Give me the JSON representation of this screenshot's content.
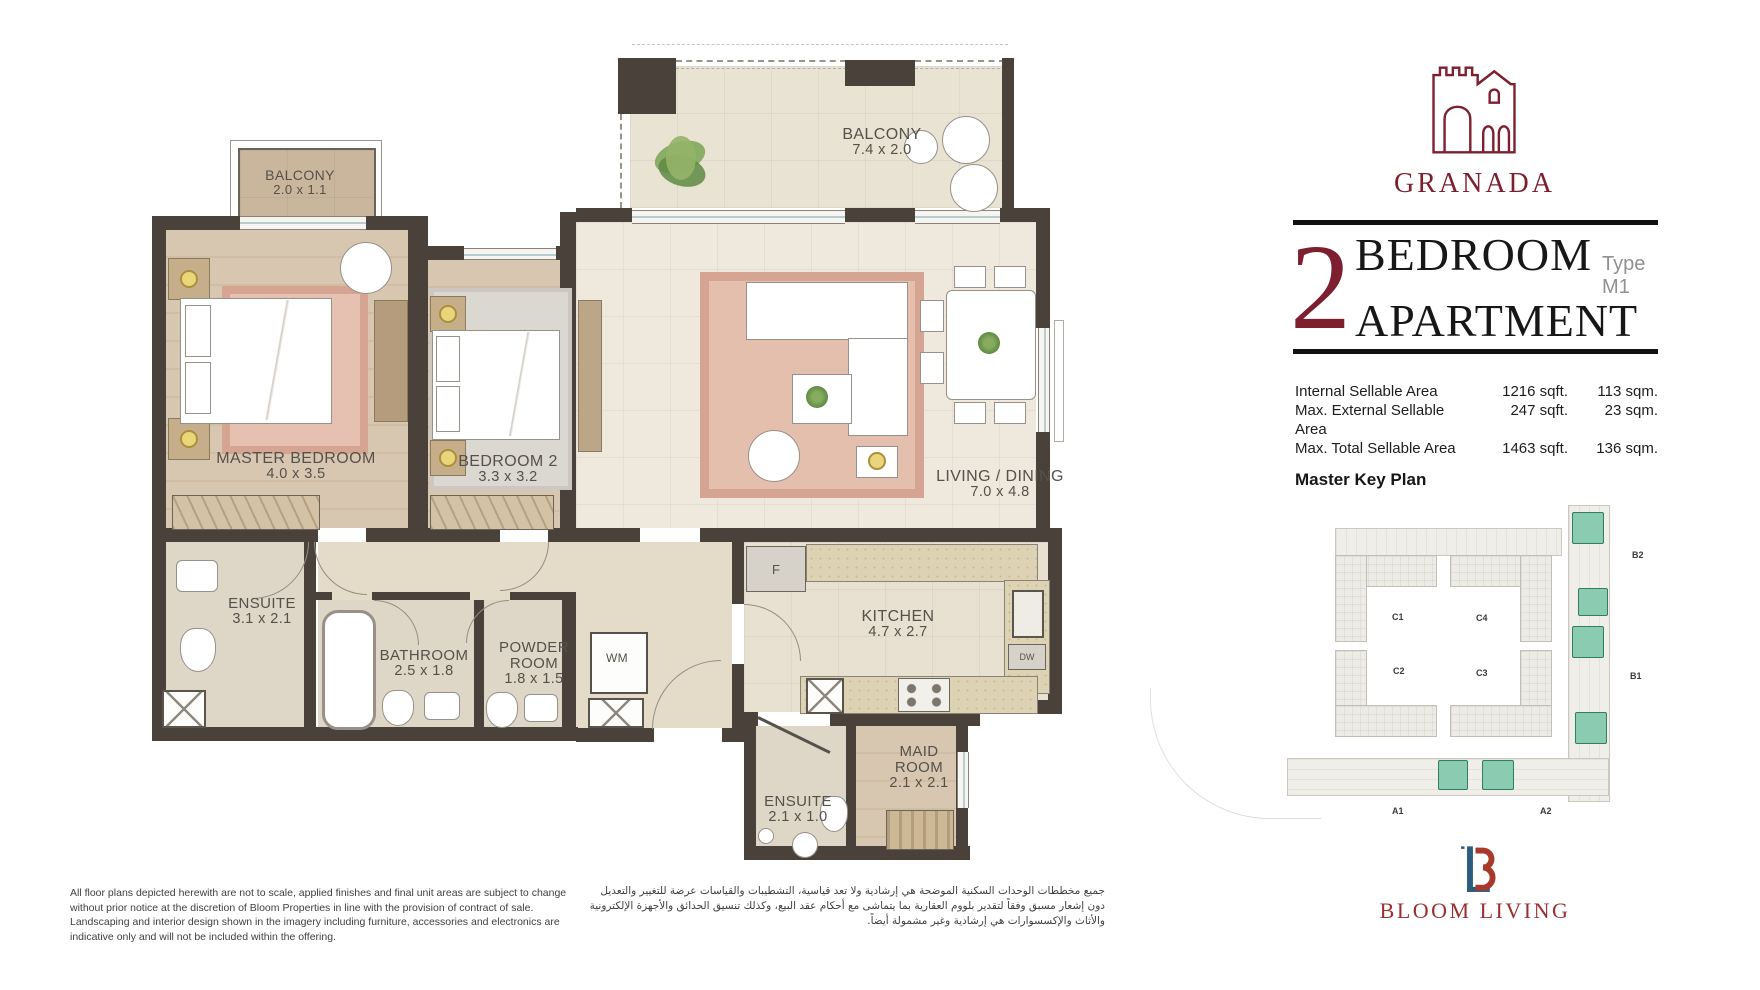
{
  "plan": {
    "rooms": [
      {
        "name": "BALCONY",
        "dims": "2.0 x 1.1"
      },
      {
        "name": "MASTER BEDROOM",
        "dims": "4.0 x 3.5"
      },
      {
        "name": "BEDROOM 2",
        "dims": "3.3 x 3.2"
      },
      {
        "name": "BALCONY",
        "dims": "7.4 x 2.0"
      },
      {
        "name": "LIVING / DINING",
        "dims": "7.0 x 4.8"
      },
      {
        "name": "ENSUITE",
        "dims": "3.1 x 2.1"
      },
      {
        "name": "BATHROOM",
        "dims": "2.5 x 1.8"
      },
      {
        "name": "POWDER ROOM",
        "dims": "1.8 x 1.5"
      },
      {
        "name": "KITCHEN",
        "dims": "4.7 x 2.7"
      },
      {
        "name": "MAID ROOM",
        "dims": "2.1 x 2.1"
      },
      {
        "name": "ENSUITE",
        "dims": "2.1 x 1.0"
      }
    ],
    "appliances": {
      "fridge": "F",
      "washer": "WM",
      "dishwasher": "DW"
    }
  },
  "panel": {
    "project_name": "GRANADA",
    "unit_number": "2",
    "unit_line1": "BEDROOM",
    "unit_line2": "APARTMENT",
    "unit_type": "Type M1",
    "areas": [
      {
        "label": "Internal Sellable Area",
        "sqft": "1216 sqft.",
        "sqm": "113 sqm."
      },
      {
        "label": "Max. External Sellable Area",
        "sqft": "247 sqft.",
        "sqm": "23 sqm."
      },
      {
        "label": "Max. Total Sellable Area",
        "sqft": "1463 sqft.",
        "sqm": "136 sqm."
      }
    ],
    "key_plan_title": "Master Key Plan",
    "key": {
      "c1": "C1",
      "c2": "C2",
      "c3": "C3",
      "c4": "C4",
      "b1": "B1",
      "b2": "B2",
      "a1": "A1",
      "a2": "A2"
    },
    "brand": "BLOOM LIVING"
  },
  "footer": {
    "disclaimer_en": "All floor plans depicted herewith are not to scale, applied finishes and final unit areas are subject to change without prior notice at the discretion of Bloom Properties in line with the provision of contract of sale. Landscaping and interior design shown in the imagery including furniture, accessories and electronics are indicative only and will not be included within the offering.",
    "disclaimer_ar": "جميع مخططات الوحدات السكنية الموضحة هي إرشادية ولا تعد قياسية، التشطيبات والقياسات عرضة للتغيير والتعديل دون إشعار مسبق وفقاً لتقدير بلووم العقارية بما يتماشى مع أحكام عقد البيع، وكذلك تنسيق الحدائق والأجهزة الإلكترونية والأثاث والإكسسوارات هي إرشادية وغير مشمولة أيضاً."
  },
  "colors": {
    "brand_maroon": "#7d1f2e",
    "bloom_red": "#a83a2c",
    "bloom_blue": "#2c5d7c",
    "keyplan_teal": "#8bcbb1",
    "wall": "#4a423a"
  }
}
